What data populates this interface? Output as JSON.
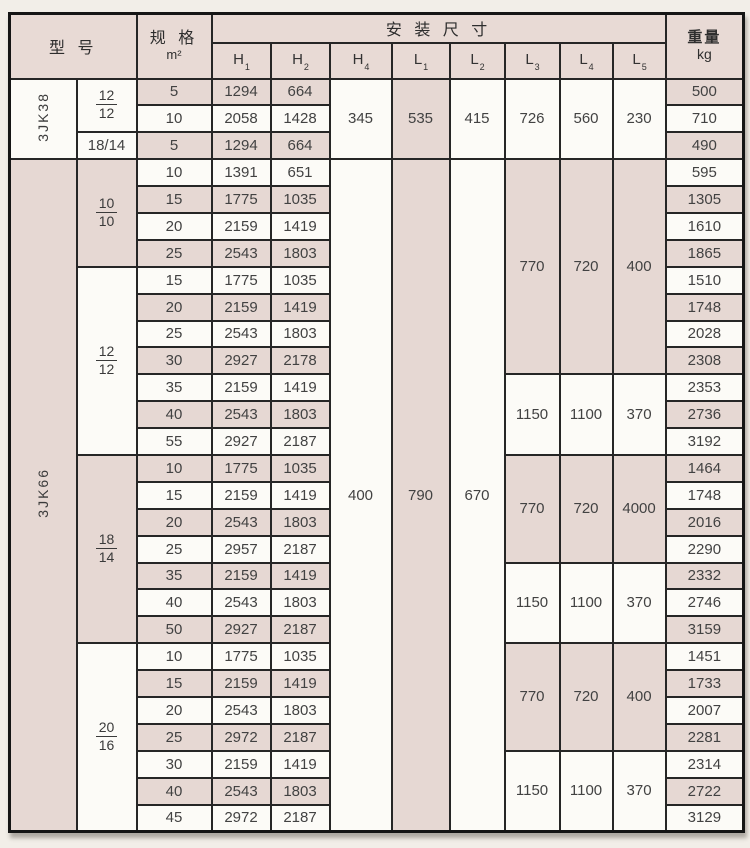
{
  "colors": {
    "pink": "#e6d8d3",
    "white": "#fcfbf7",
    "header_bg": "#e8dad5"
  },
  "header": {
    "model": "型  号",
    "spec_top": "规  格",
    "spec_unit": "m²",
    "install": "安  装  尺  寸",
    "dims": [
      {
        "b": "H",
        "s": "1"
      },
      {
        "b": "H",
        "s": "2"
      },
      {
        "b": "H",
        "s": "4"
      },
      {
        "b": "L",
        "s": "1"
      },
      {
        "b": "L",
        "s": "2"
      },
      {
        "b": "L",
        "s": "3"
      },
      {
        "b": "L",
        "s": "4"
      },
      {
        "b": "L",
        "s": "5"
      }
    ],
    "weight_top": "重量",
    "weight_unit": "kg"
  },
  "rows": [
    {
      "spec": "5",
      "h1": "1294",
      "h2": "664",
      "weight": "500"
    },
    {
      "spec": "10",
      "h1": "2058",
      "h2": "1428",
      "weight": "710"
    },
    {
      "spec": "5",
      "h1": "1294",
      "h2": "664",
      "weight": "490"
    },
    {
      "spec": "10",
      "h1": "1391",
      "h2": "651",
      "weight": "595"
    },
    {
      "spec": "15",
      "h1": "1775",
      "h2": "1035",
      "weight": "1305"
    },
    {
      "spec": "20",
      "h1": "2159",
      "h2": "1419",
      "weight": "1610"
    },
    {
      "spec": "25",
      "h1": "2543",
      "h2": "1803",
      "weight": "1865"
    },
    {
      "spec": "15",
      "h1": "1775",
      "h2": "1035",
      "weight": "1510"
    },
    {
      "spec": "20",
      "h1": "2159",
      "h2": "1419",
      "weight": "1748"
    },
    {
      "spec": "25",
      "h1": "2543",
      "h2": "1803",
      "weight": "2028"
    },
    {
      "spec": "30",
      "h1": "2927",
      "h2": "2178",
      "weight": "2308"
    },
    {
      "spec": "35",
      "h1": "2159",
      "h2": "1419",
      "weight": "2353"
    },
    {
      "spec": "40",
      "h1": "2543",
      "h2": "1803",
      "weight": "2736"
    },
    {
      "spec": "55",
      "h1": "2927",
      "h2": "2187",
      "weight": "3192"
    },
    {
      "spec": "10",
      "h1": "1775",
      "h2": "1035",
      "weight": "1464"
    },
    {
      "spec": "15",
      "h1": "2159",
      "h2": "1419",
      "weight": "1748"
    },
    {
      "spec": "20",
      "h1": "2543",
      "h2": "1803",
      "weight": "2016"
    },
    {
      "spec": "25",
      "h1": "2957",
      "h2": "2187",
      "weight": "2290"
    },
    {
      "spec": "35",
      "h1": "2159",
      "h2": "1419",
      "weight": "2332"
    },
    {
      "spec": "40",
      "h1": "2543",
      "h2": "1803",
      "weight": "2746"
    },
    {
      "spec": "50",
      "h1": "2927",
      "h2": "2187",
      "weight": "3159"
    },
    {
      "spec": "10",
      "h1": "1775",
      "h2": "1035",
      "weight": "1451"
    },
    {
      "spec": "15",
      "h1": "2159",
      "h2": "1419",
      "weight": "1733"
    },
    {
      "spec": "20",
      "h1": "2543",
      "h2": "1803",
      "weight": "2007"
    },
    {
      "spec": "25",
      "h1": "2972",
      "h2": "2187",
      "weight": "2281"
    },
    {
      "spec": "30",
      "h1": "2159",
      "h2": "1419",
      "weight": "2314"
    },
    {
      "spec": "40",
      "h1": "2543",
      "h2": "1803",
      "weight": "2722"
    },
    {
      "spec": "45",
      "h1": "2972",
      "h2": "2187",
      "weight": "3129"
    }
  ],
  "model_spans": [
    {
      "label": "3JK38",
      "from": 1,
      "to": 3,
      "bg": "white"
    },
    {
      "label": "3JK66",
      "from": 4,
      "to": 28,
      "bg": "pink"
    }
  ],
  "group_spans": [
    {
      "type": "frac",
      "num": "12",
      "den": "12",
      "from": 1,
      "to": 2,
      "bg": "white"
    },
    {
      "type": "inline",
      "label": "18/14",
      "from": 3,
      "to": 3,
      "bg": "white"
    },
    {
      "type": "frac",
      "num": "10",
      "den": "10",
      "from": 4,
      "to": 7,
      "bg": "pink"
    },
    {
      "type": "frac",
      "num": "12",
      "den": "12",
      "from": 8,
      "to": 14,
      "bg": "white"
    },
    {
      "type": "frac",
      "num": "18",
      "den": "14",
      "from": 15,
      "to": 21,
      "bg": "pink"
    },
    {
      "type": "frac",
      "num": "20",
      "den": "16",
      "from": 22,
      "to": 28,
      "bg": "white"
    }
  ],
  "h4_spans": [
    {
      "value": "345",
      "from": 1,
      "to": 3,
      "bg": "white"
    },
    {
      "value": "400",
      "from": 4,
      "to": 28,
      "bg": "white"
    }
  ],
  "l1_spans": [
    {
      "value": "535",
      "from": 1,
      "to": 3,
      "bg": "pink"
    },
    {
      "value": "790",
      "from": 4,
      "to": 28,
      "bg": "pink"
    }
  ],
  "l2_spans": [
    {
      "value": "415",
      "from": 1,
      "to": 3,
      "bg": "white"
    },
    {
      "value": "670",
      "from": 4,
      "to": 28,
      "bg": "white"
    }
  ],
  "l345_spans": [
    {
      "l3": "726",
      "l4": "560",
      "l5": "230",
      "from": 1,
      "to": 3,
      "bg": "white"
    },
    {
      "l3": "770",
      "l4": "720",
      "l5": "400",
      "from": 4,
      "to": 11,
      "bg": "pink"
    },
    {
      "l3": "1150",
      "l4": "1100",
      "l5": "370",
      "from": 12,
      "to": 14,
      "bg": "white"
    },
    {
      "l3": "770",
      "l4": "720",
      "l5": "4000",
      "from": 15,
      "to": 18,
      "bg": "pink"
    },
    {
      "l3": "1150",
      "l4": "1100",
      "l5": "370",
      "from": 19,
      "to": 21,
      "bg": "white"
    },
    {
      "l3": "770",
      "l4": "720",
      "l5": "400",
      "from": 22,
      "to": 25,
      "bg": "pink"
    },
    {
      "l3": "1150",
      "l4": "1100",
      "l5": "370",
      "from": 26,
      "to": 28,
      "bg": "white"
    }
  ]
}
